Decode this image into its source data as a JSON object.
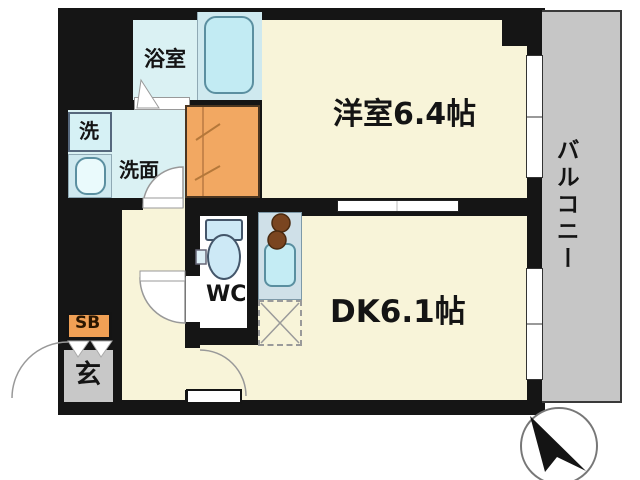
{
  "title": "apartment-floor-plan",
  "rooms": {
    "western_room": {
      "label": "洋室6.4帖",
      "area_tatami": "6.4"
    },
    "dining_kitchen": {
      "label": "DK6.1帖",
      "area_tatami": "6.1"
    },
    "balcony": {
      "label": "バルコニー"
    },
    "bathroom": {
      "label": "浴室"
    },
    "washer_space": {
      "label": "洗"
    },
    "vanity": {
      "label": "洗面"
    },
    "toilet": {
      "label": "WC"
    },
    "shoe_box": {
      "label": "SB"
    },
    "entrance": {
      "label": "玄"
    }
  },
  "icons": {
    "compass": "compass-north-needle"
  },
  "colors": {
    "wall_black": "#151515",
    "floor_cream": "#f8f4d9",
    "wet_area_blue": "#daf1f3",
    "fixture_blue": "#c2ebf3",
    "closet_orange": "#f2a862",
    "shoe_box_orange": "#f0a055",
    "entrance_gray": "#c8c8c8",
    "balcony_gray": "#c6c6c6",
    "counter_gray": "#cfe0e8"
  }
}
